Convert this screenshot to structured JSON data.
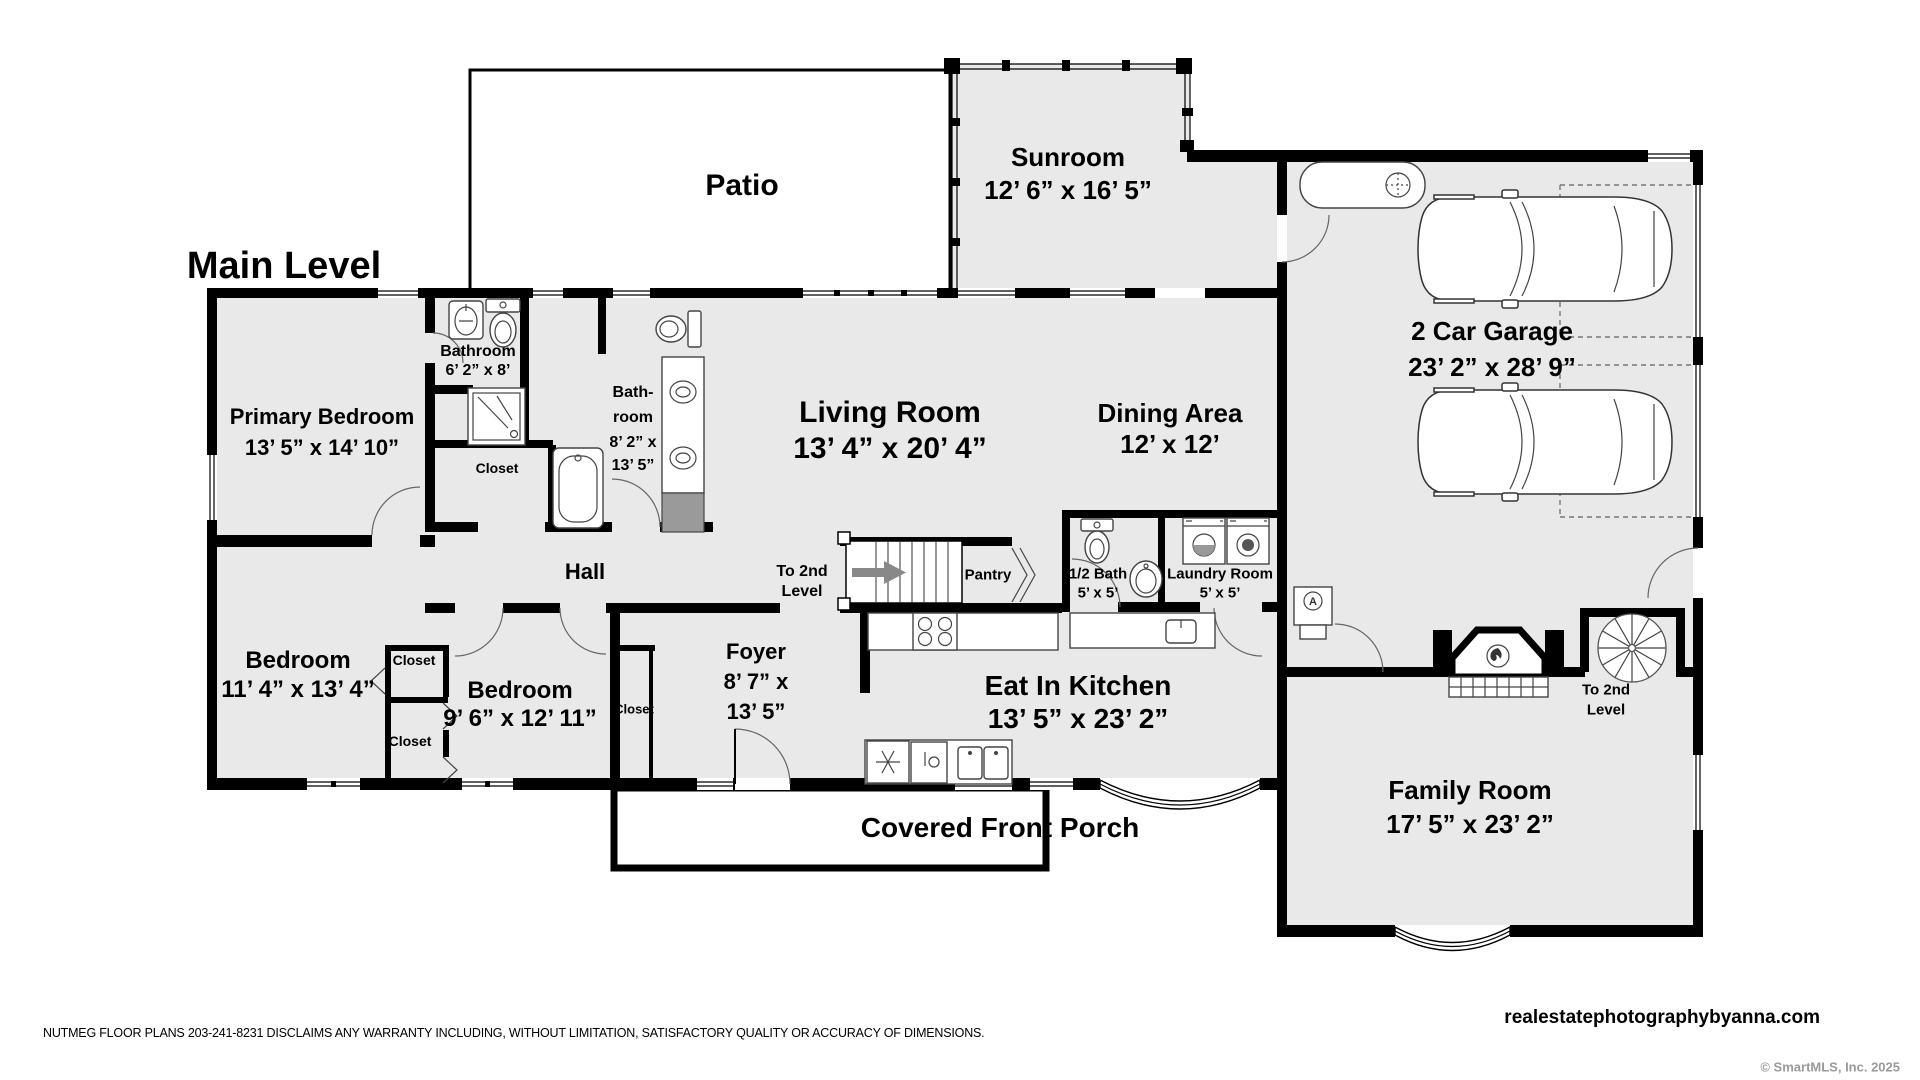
{
  "title": "Main Level",
  "rooms": {
    "patio": {
      "name": "Patio"
    },
    "sunroom": {
      "name": "Sunroom",
      "dims": "12’ 6” x 16’ 5”"
    },
    "garage": {
      "name": "2 Car Garage",
      "dims": "23’ 2” x 28’ 9”"
    },
    "primary_bedroom": {
      "name": "Primary Bedroom",
      "dims": "13’ 5” x 14’ 10”"
    },
    "bathroom": {
      "name": "Bathroom",
      "dims": "6’ 2” x 8’"
    },
    "bathroom2": {
      "line1": "Bath-",
      "line2": "room",
      "line3": "8’ 2” x",
      "line4": "13’ 5”"
    },
    "living_room": {
      "name": "Living Room",
      "dims": "13’ 4” x 20’ 4”"
    },
    "dining_area": {
      "name": "Dining Area",
      "dims": "12’ x 12’"
    },
    "hall": {
      "name": "Hall"
    },
    "bedroom1": {
      "name": "Bedroom",
      "dims": "11’ 4” x 13’ 4”"
    },
    "bedroom2": {
      "name": "Bedroom",
      "dims": "9’ 6” x 12’ 11”"
    },
    "foyer": {
      "name": "Foyer",
      "dims1": "8’ 7” x",
      "dims2": "13’ 5”"
    },
    "eat_in_kitchen": {
      "name": "Eat In Kitchen",
      "dims": "13’ 5” x 23’ 2”"
    },
    "family_room": {
      "name": "Family Room",
      "dims": "17’ 5” x 23’ 2”"
    },
    "covered_front_porch": {
      "name": "Covered Front Porch"
    },
    "half_bath": {
      "name": "1/2 Bath",
      "dims": "5’ x 5’"
    },
    "laundry_room": {
      "name": "Laundry Room",
      "dims": "5’ x 5’"
    },
    "pantry": {
      "name": "Pantry"
    },
    "closet": {
      "name": "Closet"
    },
    "stairs_main": {
      "line1": "To 2nd",
      "line2": "Level"
    },
    "stairs_spiral": {
      "line1": "To 2nd",
      "line2": "Level"
    }
  },
  "fixtures": {
    "furnace_letter": "A"
  },
  "footer": {
    "disclaimer": "NUTMEG FLOOR PLANS 203-241-8231 DISCLAIMS ANY WARRANTY INCLUDING, WITHOUT LIMITATION, SATISFACTORY QUALITY OR ACCURACY OF DIMENSIONS.",
    "website": "realestatephotographybyanna.com",
    "copyright": "© SmartMLS, Inc.  2025"
  }
}
